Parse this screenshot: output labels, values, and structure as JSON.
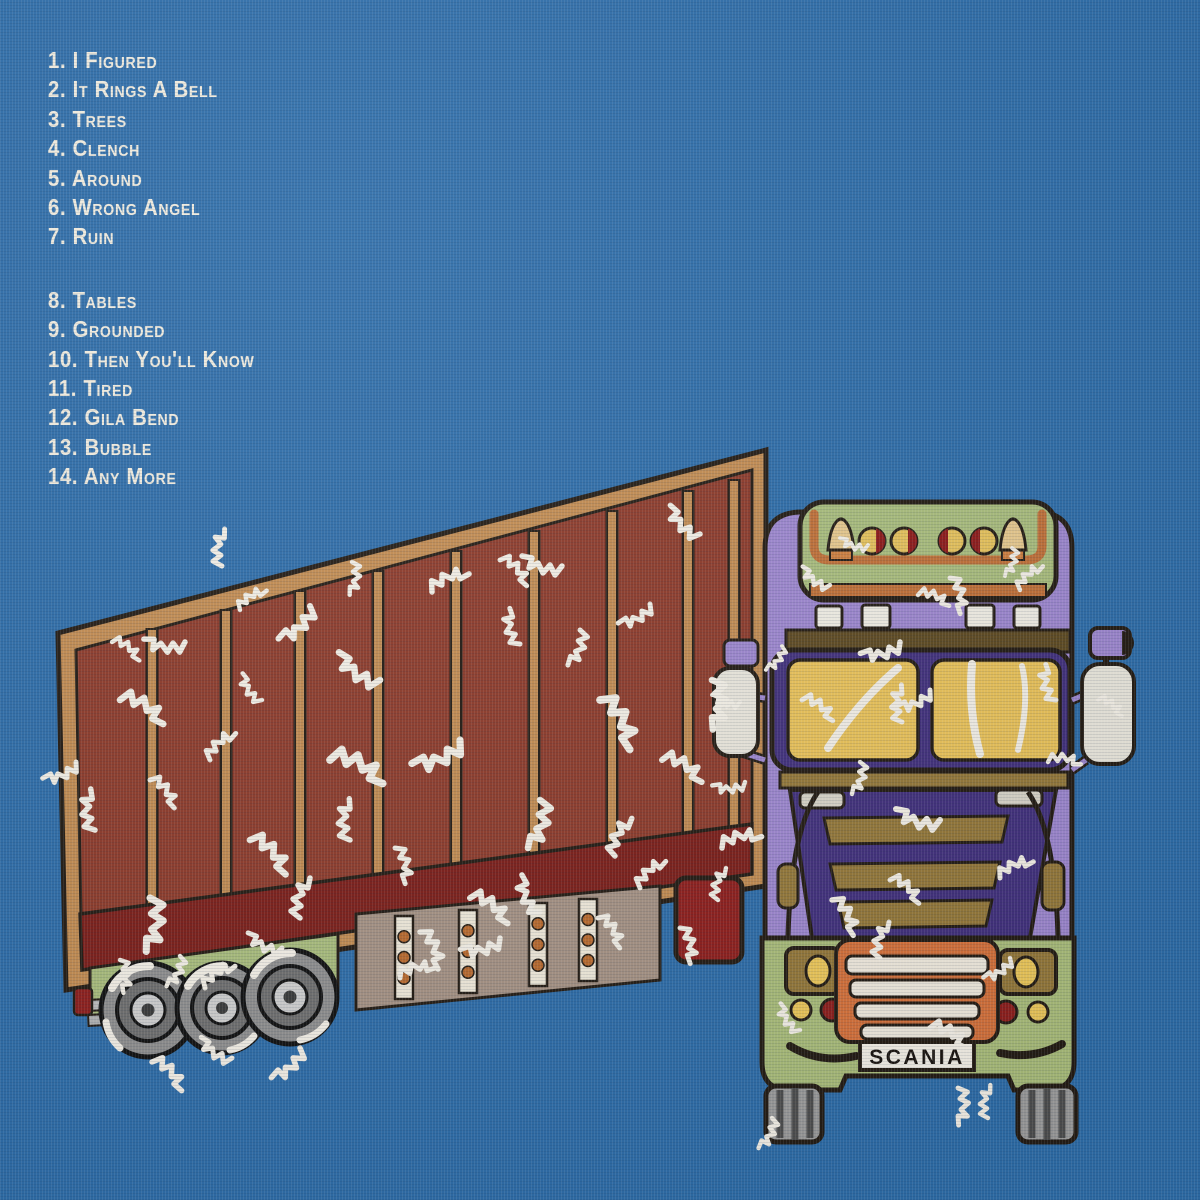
{
  "tracklist": {
    "side_a": [
      "1. I Figured",
      "2. It Rings A Bell",
      "3. Trees",
      "4. Clench",
      "5. Around",
      "6. Wrong Angel",
      "7. Ruin"
    ],
    "side_b": [
      "8. Tables",
      "9. Grounded",
      "10. Then You'll Know",
      "11. Tired",
      "12. Gila Bend",
      "13. Bubble",
      "14. Any More"
    ]
  },
  "truck": {
    "plate_label": "SCANIA"
  },
  "palette": {
    "background_blue": "#2e6da9",
    "text_white": "#f1ecdf",
    "trailer_panel_red": "#8d3b2b",
    "trailer_frame_tan": "#c28c52",
    "trailer_skirt_red": "#7c1f1a",
    "undercarriage_green": "#a9bd7d",
    "cab_purple": "#9d87cf",
    "cab_indigo": "#42317d",
    "windshield_yellow": "#e9c25a",
    "grille_gold": "#94783a",
    "grille_orange": "#d4713b",
    "paint_white": "#f3efe6",
    "tire_gray": "#8f8f8f",
    "rivet_orange": "#b96a2e",
    "mudflap_tan": "#a59284",
    "tail_light_red": "#8e1f1d",
    "outline_black": "#241c14"
  }
}
